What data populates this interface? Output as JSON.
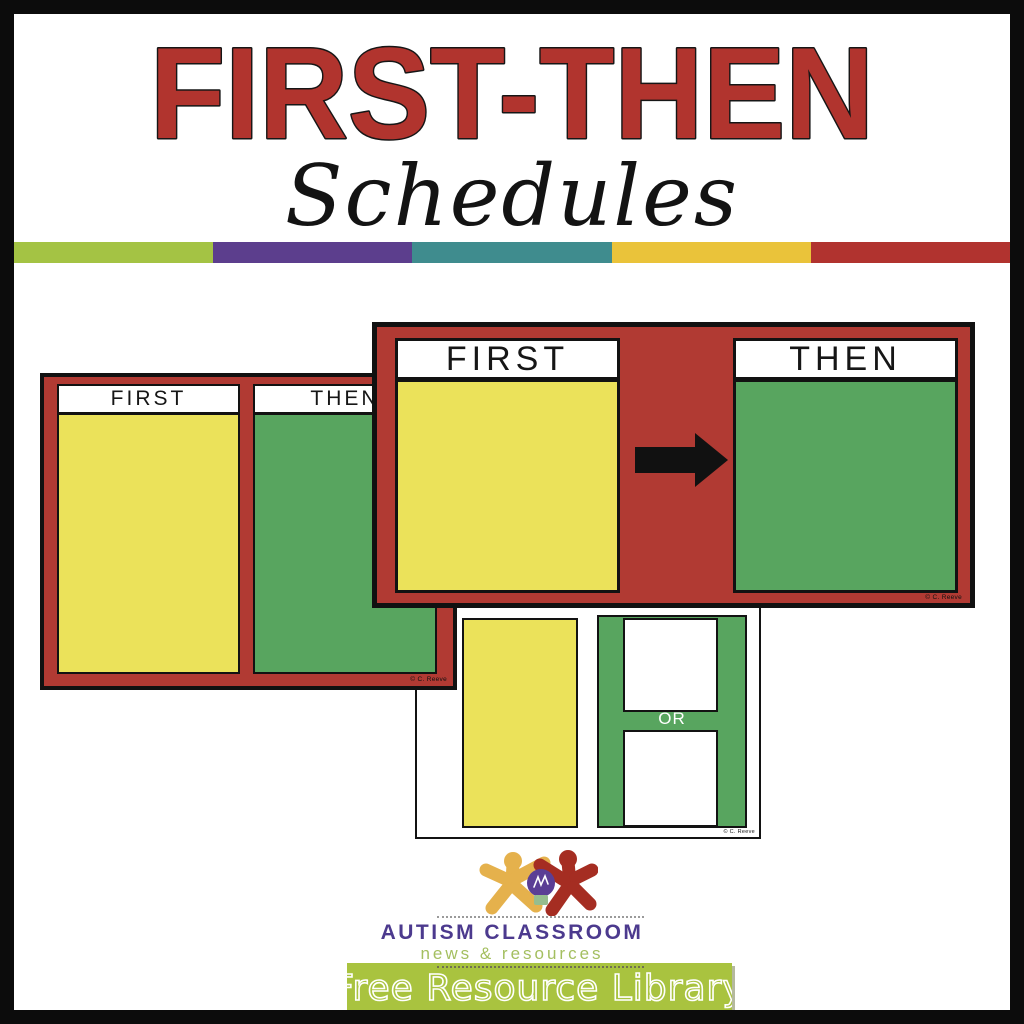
{
  "title": "FIRST-THEN",
  "subtitle": "Schedules",
  "stripe_colors": [
    "#a4c344",
    "#5c3e8d",
    "#3f8c8e",
    "#eac33a",
    "#b1332f"
  ],
  "colors": {
    "title-red": "#b1342e",
    "card-red": "#b13a33",
    "panel-yellow": "#ebe25a",
    "panel-green": "#58a55f",
    "banner-green": "#a9c33f",
    "logo-purple": "#4c3a8e",
    "logo-green": "#a4bf60",
    "figure-yellow": "#e5b14c",
    "figure-red": "#a52d22",
    "bulb-purple": "#5b3e95",
    "bulb-base": "#96bd8e"
  },
  "cards": {
    "back": {
      "first_label": "FIRST",
      "then_label": "THEN",
      "copyright": "© C. Reeve"
    },
    "front": {
      "first_label": "FIRST",
      "then_label": "THEN",
      "copyright": "© C. Reeve"
    },
    "bottom": {
      "first_label": "FIRST",
      "then_label": "THEN",
      "or_label": "OR",
      "copyright": "© C. Reeve"
    }
  },
  "logo": {
    "brand": "AUTISM CLASSROOM",
    "tagline": "news & resources"
  },
  "banner": {
    "label": "Free Resource Library"
  }
}
